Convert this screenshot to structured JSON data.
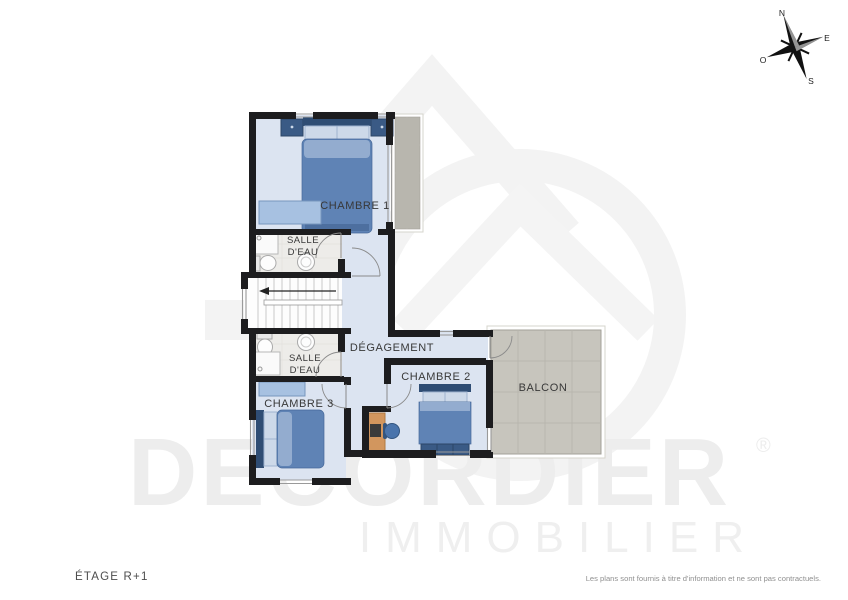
{
  "plan": {
    "rooms": {
      "chambre1": "CHAMBRE 1",
      "chambre2": "CHAMBRE 2",
      "chambre3": "CHAMBRE 3",
      "salle_eau_1_line1": "SALLE",
      "salle_eau_1_line2": "D'EAU",
      "salle_eau_2_line1": "SALLE",
      "salle_eau_2_line2": "D'EAU",
      "degagement": "DÉGAGEMENT",
      "balcon": "BALCON"
    }
  },
  "compass": {
    "north": "N",
    "east": "E",
    "south": "S",
    "west": "O"
  },
  "watermark": {
    "brand": "DECORDIER",
    "registered": "®",
    "subtitle": "IMMOBILIER"
  },
  "footer": {
    "floor_label": "ÉTAGE R+1",
    "disclaimer": "Les plans sont fournis à titre d'information et ne sont pas contractuels."
  },
  "colors": {
    "wall": "#1d1d1f",
    "room_floor": "#dce4f1",
    "bath_floor": "#edece9",
    "balcony_gray": "#c7c5bd",
    "bed_blue": "#5f83b5",
    "headboard_blue": "#2f4d74",
    "bench_blue": "#a7c1e1",
    "desk_wood": "#d2965e",
    "chair_blue": "#4a74ac",
    "watermark_gray": "#ededed"
  }
}
